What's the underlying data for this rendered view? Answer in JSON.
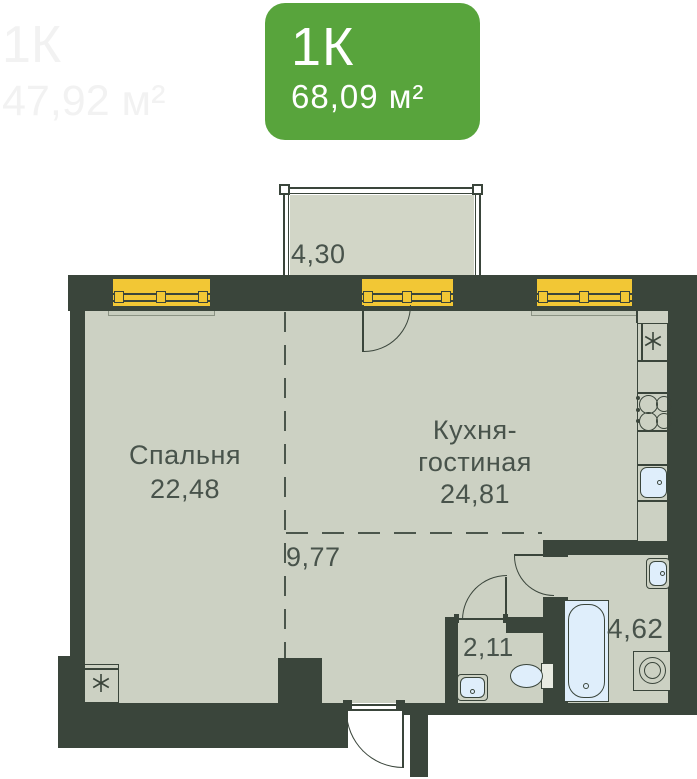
{
  "badge": {
    "rooms_label": "1К",
    "area_label": "68,09 м²",
    "color": "#58a43c"
  },
  "watermark": {
    "rooms_label": "1К",
    "area_label": "47,92 м²"
  },
  "plan": {
    "balcony": {
      "area": "4,30"
    },
    "bedroom": {
      "name": "Спальня",
      "area": "22,48"
    },
    "kitchen_living": {
      "name_line1": "Кухня-",
      "name_line2": "гостиная",
      "area": "24,81"
    },
    "hallway": {
      "area": "9,77"
    },
    "wc": {
      "area": "2,11"
    },
    "bathroom": {
      "area": "4,62"
    }
  },
  "icons": {
    "vent_symbol": "six-spoke-asterisk"
  },
  "colors": {
    "wall": "#3a453b",
    "floor": "#ccd1c3",
    "balcony_floor": "#d2d6c7",
    "window_yellow": "#f2c735",
    "fixture_blue": "#dfeefb",
    "label_text": "#48534b",
    "badge_green": "#58a43c"
  }
}
